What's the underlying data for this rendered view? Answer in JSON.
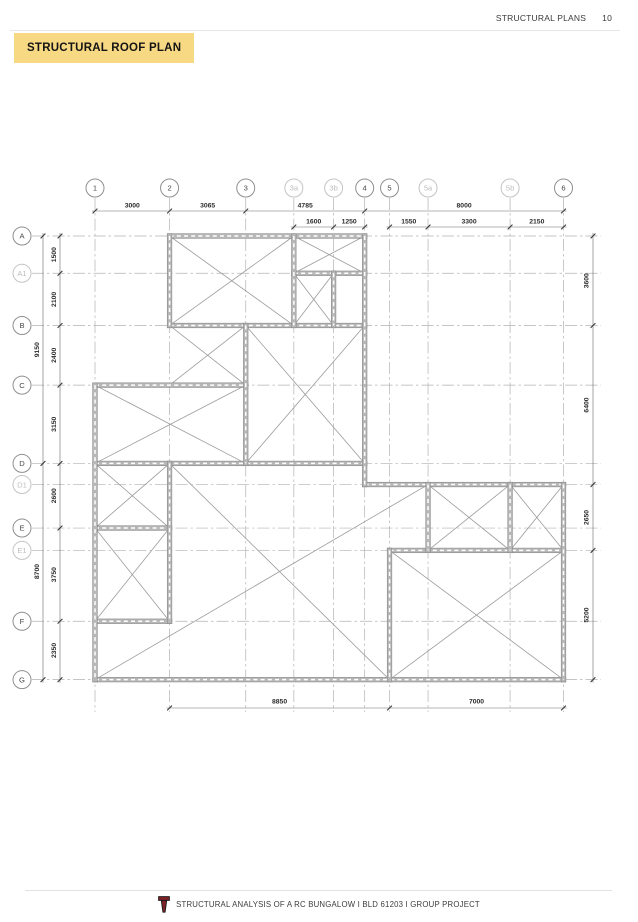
{
  "header": {
    "section_label": "STRUCTURAL PLANS",
    "page_number": "10"
  },
  "title": {
    "label": "STRUCTURAL ROOF PLAN"
  },
  "footer": {
    "label": "STRUCTURAL ANALYSIS OF A RC BUNGALOW I BLD 61203 I GROUP PROJECT",
    "logo": "torch-logo-icon"
  },
  "colors": {
    "title_highlight": "#f7d883",
    "wall_fill": "#b7b7b7",
    "wall_edge": "#888888",
    "wall_dash": "#ffffff",
    "diagonal": "#9b9b9b",
    "grid_line": "#b2b2b2",
    "dim_line": "#6a6a6a",
    "dim_tick": "#3c3c3c",
    "dim_text": "#2b2b2b",
    "bubble_major_stroke": "#8f8f8f",
    "bubble_minor_stroke": "#c4c4c4",
    "bubble_major_text": "#4a4a4a",
    "bubble_minor_text": "#bdbdbd",
    "logo_red": "#7d2128",
    "logo_outline": "#1a1a1a"
  },
  "plan": {
    "units": "mm",
    "grids_x": [
      {
        "label": "1",
        "mm": 0
      },
      {
        "label": "2",
        "mm": 3000
      },
      {
        "label": "3",
        "mm": 6065
      },
      {
        "label": "3a",
        "mm": 8000,
        "minor": true
      },
      {
        "label": "3b",
        "mm": 9600,
        "minor": true
      },
      {
        "label": "4",
        "mm": 10850
      },
      {
        "label": "5",
        "mm": 11850
      },
      {
        "label": "5a",
        "mm": 13400,
        "minor": true
      },
      {
        "label": "5b",
        "mm": 16700,
        "minor": true
      },
      {
        "label": "6",
        "mm": 18850
      }
    ],
    "grids_y": [
      {
        "label": "A",
        "mm": 0
      },
      {
        "label": "A1",
        "mm": 1500,
        "minor": true
      },
      {
        "label": "B",
        "mm": 3600
      },
      {
        "label": "C",
        "mm": 6000
      },
      {
        "label": "D",
        "mm": 9150
      },
      {
        "label": "D1",
        "mm": 10000,
        "minor": true
      },
      {
        "label": "E",
        "mm": 11750
      },
      {
        "label": "E1",
        "mm": 12650,
        "minor": true
      },
      {
        "label": "F",
        "mm": 15500
      },
      {
        "label": "G",
        "mm": 17850
      }
    ],
    "walls": [
      [
        3000,
        0,
        10850,
        0
      ],
      [
        8000,
        1500,
        10850,
        1500
      ],
      [
        3000,
        3600,
        10850,
        3600
      ],
      [
        0,
        6000,
        6065,
        6000
      ],
      [
        0,
        9150,
        10850,
        9150
      ],
      [
        10850,
        10000,
        18850,
        10000
      ],
      [
        0,
        11750,
        3000,
        11750
      ],
      [
        11850,
        12650,
        18850,
        12650
      ],
      [
        0,
        15500,
        3000,
        15500
      ],
      [
        0,
        17850,
        18850,
        17850
      ],
      [
        0,
        6000,
        0,
        17850
      ],
      [
        3000,
        0,
        3000,
        3600
      ],
      [
        3000,
        9150,
        3000,
        15500
      ],
      [
        6065,
        3600,
        6065,
        9150
      ],
      [
        8000,
        0,
        8000,
        3600
      ],
      [
        9600,
        1500,
        9600,
        3600
      ],
      [
        10850,
        0,
        10850,
        10000
      ],
      [
        11850,
        12650,
        11850,
        17850
      ],
      [
        13400,
        10000,
        13400,
        12650
      ],
      [
        16700,
        10000,
        16700,
        12650
      ],
      [
        18850,
        10000,
        18850,
        17850
      ]
    ],
    "slab_diagonals": [
      [
        3000,
        0,
        8000,
        3600
      ],
      [
        8000,
        0,
        3000,
        3600
      ],
      [
        8000,
        0,
        10850,
        1500
      ],
      [
        10850,
        0,
        8000,
        1500
      ],
      [
        8000,
        1500,
        9600,
        3600
      ],
      [
        9600,
        1500,
        8000,
        3600
      ],
      [
        3000,
        3600,
        6065,
        6000
      ],
      [
        6065,
        3600,
        3000,
        6000
      ],
      [
        6065,
        3600,
        10850,
        9150
      ],
      [
        10850,
        3600,
        6065,
        9150
      ],
      [
        0,
        6000,
        6065,
        9150
      ],
      [
        6065,
        6000,
        0,
        9150
      ],
      [
        0,
        9150,
        3000,
        11750
      ],
      [
        3000,
        9150,
        0,
        11750
      ],
      [
        0,
        11750,
        3000,
        15500
      ],
      [
        3000,
        11750,
        0,
        15500
      ],
      [
        13400,
        10000,
        16700,
        12650
      ],
      [
        16700,
        10000,
        13400,
        12650
      ],
      [
        16700,
        10000,
        18850,
        12650
      ],
      [
        18850,
        10000,
        16700,
        12650
      ],
      [
        11850,
        12650,
        18850,
        17850
      ],
      [
        18850,
        12650,
        11850,
        17850
      ],
      [
        0,
        17850,
        13400,
        10000
      ],
      [
        3000,
        9150,
        11850,
        17850
      ]
    ],
    "dimensions": {
      "top_row1": {
        "segments": [
          [
            0,
            3000,
            "3000"
          ],
          [
            3000,
            6065,
            "3065"
          ],
          [
            6065,
            10850,
            "4785"
          ],
          [
            10850,
            18850,
            "8000"
          ]
        ]
      },
      "top_row2": {
        "lines": [
          {
            "segments": [
              [
                8000,
                9600,
                "1600"
              ],
              [
                9600,
                10850,
                "1250"
              ]
            ]
          },
          {
            "segments": [
              [
                11850,
                13400,
                "1550"
              ],
              [
                13400,
                16700,
                "3300"
              ],
              [
                16700,
                18850,
                "2150"
              ]
            ]
          }
        ]
      },
      "left_inner": {
        "segments": [
          [
            0,
            1500,
            "1500"
          ],
          [
            1500,
            3600,
            "2100"
          ],
          [
            3600,
            6000,
            "2400"
          ],
          [
            6000,
            9150,
            "3150"
          ],
          [
            9150,
            11750,
            "2600"
          ],
          [
            11750,
            15500,
            "3750"
          ],
          [
            15500,
            17850,
            "2350"
          ]
        ]
      },
      "left_outer": {
        "segments": [
          [
            0,
            9150,
            "9150"
          ],
          [
            9150,
            17850,
            "8700"
          ]
        ]
      },
      "right": {
        "segments": [
          [
            0,
            3600,
            "3600"
          ],
          [
            3600,
            10000,
            "6400"
          ],
          [
            10000,
            12650,
            "2650"
          ],
          [
            12650,
            17850,
            "5200"
          ]
        ]
      },
      "bottom": {
        "segments": [
          [
            3000,
            11850,
            "8850"
          ],
          [
            11850,
            18850,
            "7000"
          ]
        ]
      }
    }
  }
}
